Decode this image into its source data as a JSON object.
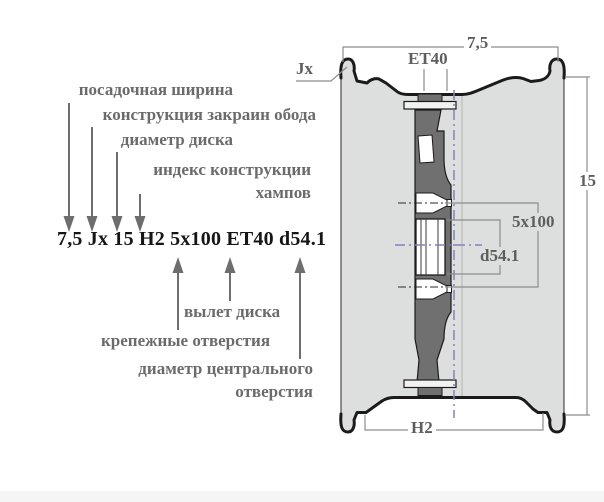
{
  "marking": {
    "code": "7,5 Jx 15 H2 5x100 ET40 d54.1"
  },
  "callouts_top": {
    "seat_width": "посадочная ширина",
    "flange_design": "конструкция закраин обода",
    "disc_diameter": "диаметр диска",
    "hump_index_line1": "индекс конструкции",
    "hump_index_line2": "хампов"
  },
  "callouts_bottom": {
    "offset": "вылет диска",
    "bolt_holes": "крепежные отверстия",
    "center_bore_line1": "диаметр центрального",
    "center_bore_line2": "отверстия"
  },
  "drawing_dims": {
    "rim_width": "7,5",
    "flange_type": "Jx",
    "offset": "ET40",
    "diameter": "15",
    "bolt_pattern": "5x100",
    "center_bore": "d54.1",
    "hump": "H2"
  },
  "colors": {
    "label_gray": "#6b6b6b",
    "marking_black": "#161616",
    "rim_fill": "#dcdfdd",
    "disc_fill": "#707070",
    "centerline_blue": "#8282bc",
    "dim_line_gray": "#8d8d8d",
    "outline_black": "#1b1b1b"
  }
}
